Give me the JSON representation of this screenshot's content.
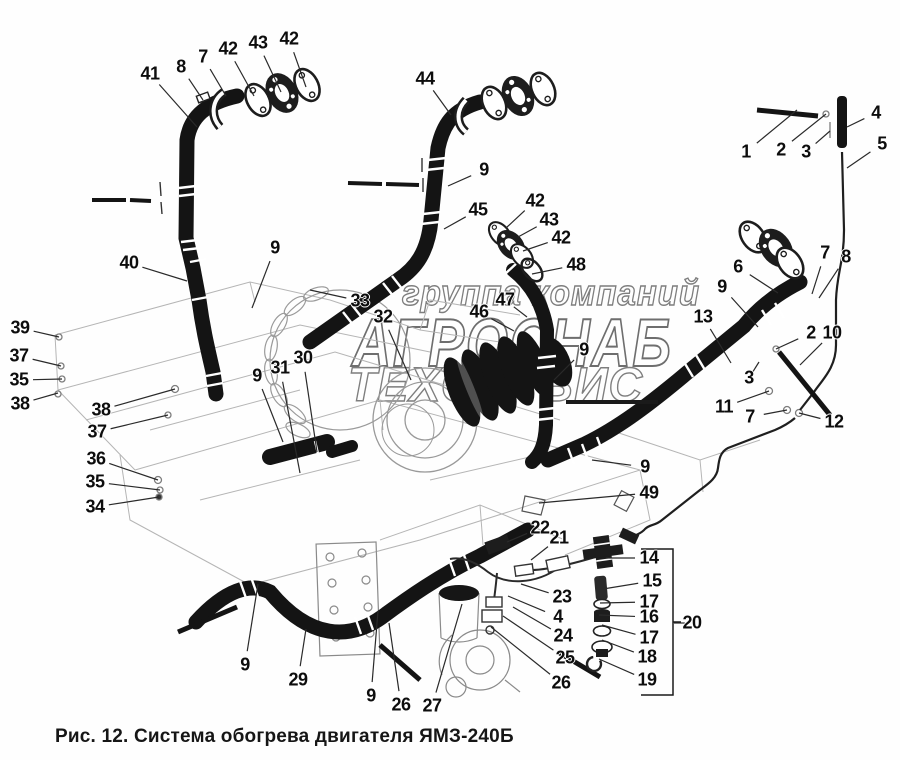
{
  "caption": "Рис. 12. Система обогрева двигателя ЯМЗ-240Б",
  "watermark": {
    "line1": "группа компаний",
    "line2": "АГРОСНАБ",
    "line3": "ТЕХСЕРВИС"
  },
  "colors": {
    "ink": "#151515",
    "engine_outline": "#b5b5b5",
    "watermark_outline": "#7e7e7e",
    "leader_line": "#2a2a2a"
  },
  "callouts": [
    {
      "t": "41",
      "x": 150,
      "y": 74,
      "tx": 197,
      "ty": 127
    },
    {
      "t": "8",
      "x": 181,
      "y": 67,
      "tx": 203,
      "ty": 100
    },
    {
      "t": "7",
      "x": 203,
      "y": 57,
      "tx": 226,
      "ty": 96
    },
    {
      "t": "42",
      "x": 228,
      "y": 49,
      "tx": 254,
      "ty": 96
    },
    {
      "t": "43",
      "x": 258,
      "y": 43,
      "tx": 281,
      "ty": 92
    },
    {
      "t": "42",
      "x": 289,
      "y": 39,
      "tx": 306,
      "ty": 87
    },
    {
      "t": "44",
      "x": 425,
      "y": 79,
      "tx": 451,
      "ty": 115
    },
    {
      "t": "9",
      "x": 484,
      "y": 170,
      "tx": 448,
      "ty": 186
    },
    {
      "t": "45",
      "x": 478,
      "y": 210,
      "tx": 444,
      "ty": 229
    },
    {
      "t": "42",
      "x": 535,
      "y": 201,
      "tx": 506,
      "ty": 228
    },
    {
      "t": "43",
      "x": 549,
      "y": 220,
      "tx": 518,
      "ty": 237
    },
    {
      "t": "42",
      "x": 561,
      "y": 238,
      "tx": 523,
      "ty": 251
    },
    {
      "t": "48",
      "x": 576,
      "y": 265,
      "tx": 532,
      "ty": 274
    },
    {
      "t": "47",
      "x": 505,
      "y": 300,
      "tx": 527,
      "ty": 317
    },
    {
      "t": "46",
      "x": 479,
      "y": 312,
      "tx": 514,
      "ty": 331
    },
    {
      "t": "9",
      "x": 584,
      "y": 350,
      "tx": 554,
      "ty": 380
    },
    {
      "t": "1",
      "x": 746,
      "y": 152,
      "tx": 797,
      "ty": 110
    },
    {
      "t": "2",
      "x": 781,
      "y": 150,
      "tx": 826,
      "ty": 114
    },
    {
      "t": "3",
      "x": 806,
      "y": 152,
      "tx": 830,
      "ty": 131
    },
    {
      "t": "4",
      "x": 876,
      "y": 113,
      "tx": 847,
      "ty": 127
    },
    {
      "t": "5",
      "x": 882,
      "y": 144,
      "tx": 847,
      "ty": 168
    },
    {
      "t": "6",
      "x": 738,
      "y": 267,
      "tx": 778,
      "ty": 293
    },
    {
      "t": "7",
      "x": 825,
      "y": 253,
      "tx": 812,
      "ty": 294
    },
    {
      "t": "8",
      "x": 846,
      "y": 257,
      "tx": 819,
      "ty": 298
    },
    {
      "t": "9",
      "x": 722,
      "y": 287,
      "tx": 758,
      "ty": 327
    },
    {
      "t": "13",
      "x": 703,
      "y": 317,
      "tx": 731,
      "ty": 363
    },
    {
      "t": "2",
      "x": 811,
      "y": 333,
      "tx": 776,
      "ty": 349
    },
    {
      "t": "10",
      "x": 832,
      "y": 333,
      "tx": 800,
      "ty": 365
    },
    {
      "t": "3",
      "x": 749,
      "y": 378,
      "tx": 759,
      "ty": 362
    },
    {
      "t": "11",
      "x": 724,
      "y": 407,
      "tx": 769,
      "ty": 391
    },
    {
      "t": "7",
      "x": 750,
      "y": 417,
      "tx": 787,
      "ty": 410
    },
    {
      "t": "12",
      "x": 834,
      "y": 422,
      "tx": 799,
      "ty": 413
    },
    {
      "t": "39",
      "x": 20,
      "y": 328,
      "tx": 59,
      "ty": 337
    },
    {
      "t": "37",
      "x": 19,
      "y": 356,
      "tx": 61,
      "ty": 366
    },
    {
      "t": "35",
      "x": 19,
      "y": 380,
      "tx": 62,
      "ty": 379
    },
    {
      "t": "38",
      "x": 20,
      "y": 404,
      "tx": 58,
      "ty": 393
    },
    {
      "t": "38",
      "x": 101,
      "y": 410,
      "tx": 175,
      "ty": 389
    },
    {
      "t": "37",
      "x": 97,
      "y": 432,
      "tx": 168,
      "ty": 415
    },
    {
      "t": "36",
      "x": 96,
      "y": 459,
      "tx": 158,
      "ty": 480
    },
    {
      "t": "35",
      "x": 95,
      "y": 482,
      "tx": 160,
      "ty": 490
    },
    {
      "t": "34",
      "x": 95,
      "y": 507,
      "tx": 159,
      "ty": 497
    },
    {
      "t": "40",
      "x": 129,
      "y": 263,
      "tx": 187,
      "ty": 281
    },
    {
      "t": "9",
      "x": 275,
      "y": 248,
      "tx": 252,
      "ty": 308
    },
    {
      "t": "33",
      "x": 360,
      "y": 301,
      "tx": 310,
      "ty": 290
    },
    {
      "t": "32",
      "x": 383,
      "y": 317,
      "tx": 411,
      "ty": 380
    },
    {
      "t": "30",
      "x": 303,
      "y": 358,
      "tx": 317,
      "ty": 452
    },
    {
      "t": "31",
      "x": 280,
      "y": 368,
      "tx": 300,
      "ty": 473
    },
    {
      "t": "9",
      "x": 257,
      "y": 376,
      "tx": 283,
      "ty": 442
    },
    {
      "t": "9",
      "x": 645,
      "y": 467,
      "tx": 592,
      "ty": 460
    },
    {
      "t": "49",
      "x": 649,
      "y": 493,
      "tx": 539,
      "ty": 503
    },
    {
      "t": "22",
      "x": 540,
      "y": 528,
      "tx": 507,
      "ty": 542
    },
    {
      "t": "21",
      "x": 559,
      "y": 538,
      "tx": 531,
      "ty": 560
    },
    {
      "t": "23",
      "x": 562,
      "y": 597,
      "tx": 521,
      "ty": 584
    },
    {
      "t": "4",
      "x": 558,
      "y": 617,
      "tx": 508,
      "ty": 596
    },
    {
      "t": "24",
      "x": 563,
      "y": 636,
      "tx": 513,
      "ty": 607
    },
    {
      "t": "25",
      "x": 565,
      "y": 658,
      "tx": 503,
      "ty": 616
    },
    {
      "t": "26",
      "x": 561,
      "y": 683,
      "tx": 491,
      "ty": 627
    },
    {
      "t": "14",
      "x": 649,
      "y": 558,
      "tx": 606,
      "ty": 558
    },
    {
      "t": "15",
      "x": 652,
      "y": 581,
      "tx": 603,
      "ty": 589
    },
    {
      "t": "17",
      "x": 649,
      "y": 602,
      "tx": 600,
      "ty": 603
    },
    {
      "t": "16",
      "x": 649,
      "y": 617,
      "tx": 599,
      "ty": 615
    },
    {
      "t": "17",
      "x": 649,
      "y": 638,
      "tx": 602,
      "ty": 625
    },
    {
      "t": "18",
      "x": 647,
      "y": 657,
      "tx": 602,
      "ty": 640
    },
    {
      "t": "19",
      "x": 647,
      "y": 680,
      "tx": 599,
      "ty": 659
    },
    {
      "t": "20",
      "x": 692,
      "y": 623,
      "tx": 674,
      "ty": 623
    },
    {
      "t": "9",
      "x": 245,
      "y": 665,
      "tx": 258,
      "ty": 584
    },
    {
      "t": "29",
      "x": 298,
      "y": 680,
      "tx": 306,
      "ty": 629
    },
    {
      "t": "9",
      "x": 371,
      "y": 696,
      "tx": 378,
      "ty": 611
    },
    {
      "t": "26",
      "x": 401,
      "y": 705,
      "tx": 389,
      "ty": 623
    },
    {
      "t": "27",
      "x": 432,
      "y": 706,
      "tx": 462,
      "ty": 604
    }
  ]
}
